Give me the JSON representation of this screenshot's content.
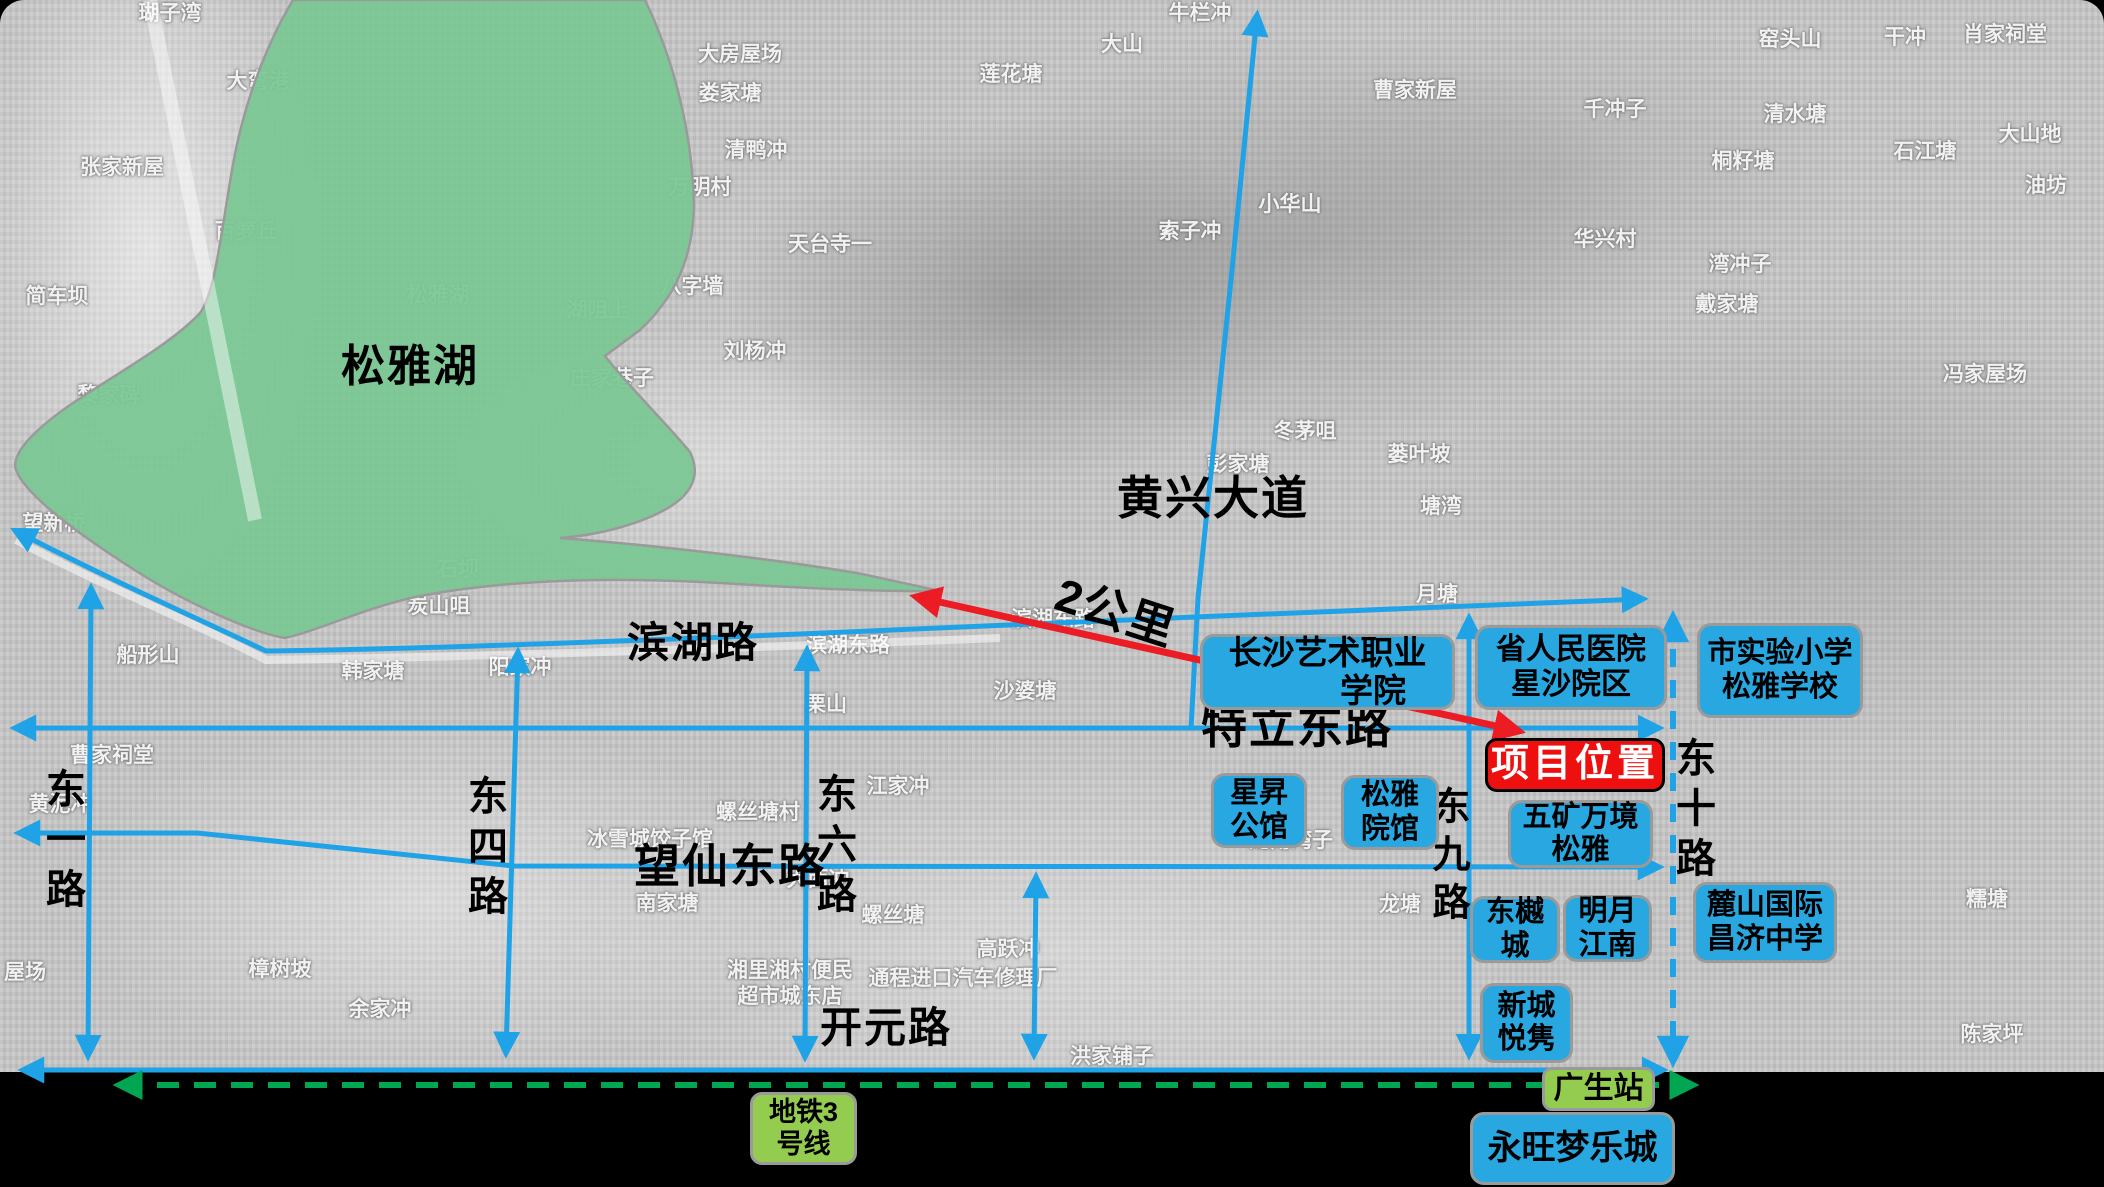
{
  "lake": {
    "name": "松雅湖",
    "fill_color": "#7bc795"
  },
  "scale_arrow": {
    "label": "2公里",
    "color": "#ec1c24"
  },
  "colors": {
    "road_blue": "#1fa3e6",
    "poi_blue": "#29a7e0",
    "metro_green": "#00a651",
    "station_green": "#94cc50",
    "project_red": "#ee0f0f"
  },
  "road_labels": [
    {
      "t": "松雅湖",
      "x": 410,
      "y": 367,
      "fs": 44,
      "vert": 0,
      "rot": 0
    },
    {
      "t": "滨湖路",
      "x": 693,
      "y": 643,
      "fs": 42,
      "vert": 0,
      "rot": 0
    },
    {
      "t": "特立东路",
      "x": 1297,
      "y": 727,
      "fs": 46,
      "vert": 0,
      "rot": 0
    },
    {
      "t": "望仙东路",
      "x": 730,
      "y": 866,
      "fs": 46,
      "vert": 0,
      "rot": 0
    },
    {
      "t": "开元路",
      "x": 886,
      "y": 1028,
      "fs": 42,
      "vert": 0,
      "rot": 0
    },
    {
      "t": "黄兴大道",
      "x": 1213,
      "y": 498,
      "fs": 46,
      "vert": 0,
      "rot": 0
    },
    {
      "t": "2公里",
      "x": 1116,
      "y": 612,
      "fs": 46,
      "vert": 0,
      "rot": 18
    },
    {
      "t": "东一路",
      "x": 62,
      "y": 843,
      "fs": 40,
      "vert": 1,
      "rot": 0
    },
    {
      "t": "东四路",
      "x": 484,
      "y": 850,
      "fs": 40,
      "vert": 1,
      "rot": 0
    },
    {
      "t": "东六路",
      "x": 833,
      "y": 848,
      "fs": 40,
      "vert": 1,
      "rot": 0
    },
    {
      "t": "东九路",
      "x": 1447,
      "y": 858,
      "fs": 38,
      "vert": 1,
      "rot": 0
    },
    {
      "t": "东十路",
      "x": 1692,
      "y": 812,
      "fs": 40,
      "vert": 1,
      "rot": 0
    }
  ],
  "boxes": [
    {
      "kind": "project",
      "name": "project-location",
      "x": 1485,
      "y": 738,
      "w": 180,
      "h": 54,
      "fs": 38,
      "lines": [
        "项目位置"
      ]
    },
    {
      "kind": "poi",
      "name": "changsha-art-college",
      "x": 1200,
      "y": 634,
      "w": 255,
      "h": 76,
      "fs": 33,
      "lines": [
        "长沙艺术职业",
        "学院"
      ],
      "align2": "right"
    },
    {
      "kind": "poi",
      "name": "provincial-peoples-hospital",
      "x": 1475,
      "y": 625,
      "w": 192,
      "h": 85,
      "fs": 30,
      "lines": [
        "省人民医院",
        "星沙院区"
      ]
    },
    {
      "kind": "poi",
      "name": "city-experimental-primary-school",
      "x": 1697,
      "y": 623,
      "w": 166,
      "h": 95,
      "fs": 29,
      "lines": [
        "市实验小学",
        "松雅学校"
      ]
    },
    {
      "kind": "poi",
      "name": "xingsheng-mansion",
      "x": 1211,
      "y": 773,
      "w": 96,
      "h": 75,
      "fs": 29,
      "lines": [
        "星昇",
        "公馆"
      ]
    },
    {
      "kind": "poi",
      "name": "songya-yuanguan",
      "x": 1341,
      "y": 775,
      "w": 98,
      "h": 75,
      "fs": 29,
      "lines": [
        "松雅",
        "院馆"
      ]
    },
    {
      "kind": "poi",
      "name": "wukuang-wanjing-songya",
      "x": 1508,
      "y": 800,
      "w": 145,
      "h": 68,
      "fs": 29,
      "lines": [
        "五矿万境",
        "松雅"
      ]
    },
    {
      "kind": "poi",
      "name": "dongyue-city",
      "x": 1470,
      "y": 896,
      "w": 90,
      "h": 67,
      "fs": 29,
      "lines": [
        "东樾",
        "城"
      ]
    },
    {
      "kind": "poi",
      "name": "mingyue-jiangnan",
      "x": 1563,
      "y": 895,
      "w": 89,
      "h": 67,
      "fs": 29,
      "lines": [
        "明月",
        "江南"
      ]
    },
    {
      "kind": "poi",
      "name": "lushan-international-school",
      "x": 1693,
      "y": 882,
      "w": 144,
      "h": 81,
      "fs": 29,
      "lines": [
        "麓山国际",
        "昌济中学"
      ]
    },
    {
      "kind": "poi",
      "name": "xincheng-yuejun",
      "x": 1480,
      "y": 983,
      "w": 93,
      "h": 80,
      "fs": 29,
      "lines": [
        "新城",
        "悦隽"
      ]
    },
    {
      "kind": "poi",
      "name": "aeon-mall",
      "x": 1470,
      "y": 1112,
      "w": 205,
      "h": 73,
      "fs": 34,
      "lines": [
        "永旺梦乐城"
      ]
    },
    {
      "kind": "station",
      "name": "guangsheng-station",
      "x": 1542,
      "y": 1067,
      "w": 113,
      "h": 44,
      "fs": 30,
      "lines": [
        "广生站"
      ]
    },
    {
      "kind": "metro",
      "name": "metro-line-3",
      "x": 750,
      "y": 1092,
      "w": 107,
      "h": 73,
      "fs": 27,
      "lines": [
        "地铁3",
        "号线"
      ]
    }
  ],
  "bg_labels": [
    {
      "t": "瑚子湾",
      "x": 170,
      "y": 14
    },
    {
      "t": "大弯港",
      "x": 258,
      "y": 82
    },
    {
      "t": "张家新屋",
      "x": 122,
      "y": 168
    },
    {
      "t": "百箩丘",
      "x": 246,
      "y": 232
    },
    {
      "t": "简车坝",
      "x": 57,
      "y": 297
    },
    {
      "t": "黎家碑",
      "x": 109,
      "y": 396
    },
    {
      "t": "望新桥",
      "x": 54,
      "y": 524
    },
    {
      "t": "船形山",
      "x": 148,
      "y": 656
    },
    {
      "t": "曹家祠堂",
      "x": 112,
      "y": 756
    },
    {
      "t": "黄泥冲",
      "x": 60,
      "y": 805
    },
    {
      "t": "屋场",
      "x": 25,
      "y": 973
    },
    {
      "t": "樟树坡",
      "x": 280,
      "y": 970
    },
    {
      "t": "余家冲",
      "x": 380,
      "y": 1010
    },
    {
      "t": "松雅湖",
      "x": 438,
      "y": 296
    },
    {
      "t": "湖咀上",
      "x": 598,
      "y": 311
    },
    {
      "t": "庄家巷子",
      "x": 612,
      "y": 379
    },
    {
      "t": "八字墙",
      "x": 692,
      "y": 287
    },
    {
      "t": "大房屋场",
      "x": 740,
      "y": 55
    },
    {
      "t": "娄家塘",
      "x": 730,
      "y": 94
    },
    {
      "t": "清鸭冲",
      "x": 756,
      "y": 151
    },
    {
      "t": "万明村",
      "x": 700,
      "y": 188
    },
    {
      "t": "天台寺一",
      "x": 830,
      "y": 245
    },
    {
      "t": "刘杨冲",
      "x": 755,
      "y": 352
    },
    {
      "t": "石坝",
      "x": 458,
      "y": 570
    },
    {
      "t": "炭山咀",
      "x": 439,
      "y": 607
    },
    {
      "t": "韩家塘",
      "x": 373,
      "y": 672
    },
    {
      "t": "阳家冲",
      "x": 520,
      "y": 668
    },
    {
      "t": "滨湖东路",
      "x": 848,
      "y": 646
    },
    {
      "t": "滨湖东路",
      "x": 1053,
      "y": 620
    },
    {
      "t": "沙婆塘",
      "x": 1025,
      "y": 692
    },
    {
      "t": "栗山",
      "x": 826,
      "y": 705
    },
    {
      "t": "江家冲",
      "x": 898,
      "y": 787
    },
    {
      "t": "螺丝塘村",
      "x": 758,
      "y": 813
    },
    {
      "t": "冰雪城饺子馆",
      "x": 650,
      "y": 840
    },
    {
      "t": "大西冲",
      "x": 818,
      "y": 880
    },
    {
      "t": "南家塘",
      "x": 667,
      "y": 904
    },
    {
      "t": "螺丝塘",
      "x": 893,
      "y": 916
    },
    {
      "t": "高跃冲",
      "x": 1008,
      "y": 950
    },
    {
      "t": "湘里湘村便民\n超市城东店",
      "x": 790,
      "y": 984
    },
    {
      "t": "通程进口汽车修理厂",
      "x": 963,
      "y": 979
    },
    {
      "t": "洪家铺子",
      "x": 1112,
      "y": 1057
    },
    {
      "t": "龙角湾子",
      "x": 1291,
      "y": 841
    },
    {
      "t": "龙塘",
      "x": 1400,
      "y": 905
    },
    {
      "t": "牛栏冲",
      "x": 1200,
      "y": 14
    },
    {
      "t": "大山",
      "x": 1122,
      "y": 45
    },
    {
      "t": "莲花塘",
      "x": 1011,
      "y": 75
    },
    {
      "t": "曹家新屋",
      "x": 1415,
      "y": 91
    },
    {
      "t": "千冲子",
      "x": 1615,
      "y": 110
    },
    {
      "t": "桐籽塘",
      "x": 1743,
      "y": 162
    },
    {
      "t": "清水塘",
      "x": 1795,
      "y": 115
    },
    {
      "t": "石江塘",
      "x": 1925,
      "y": 152
    },
    {
      "t": "大山地",
      "x": 2030,
      "y": 135
    },
    {
      "t": "油坊",
      "x": 2046,
      "y": 186
    },
    {
      "t": "窑头山",
      "x": 1790,
      "y": 40
    },
    {
      "t": "干冲",
      "x": 1905,
      "y": 38
    },
    {
      "t": "肖家祠堂",
      "x": 2005,
      "y": 35
    },
    {
      "t": "小华山",
      "x": 1290,
      "y": 205
    },
    {
      "t": "索子冲",
      "x": 1190,
      "y": 232
    },
    {
      "t": "华兴村",
      "x": 1605,
      "y": 240
    },
    {
      "t": "湾冲子",
      "x": 1740,
      "y": 265
    },
    {
      "t": "戴家塘",
      "x": 1727,
      "y": 305
    },
    {
      "t": "冯家屋场",
      "x": 1985,
      "y": 375
    },
    {
      "t": "冬茅咀",
      "x": 1305,
      "y": 432
    },
    {
      "t": "彭家塘",
      "x": 1238,
      "y": 465
    },
    {
      "t": "蒌叶坡",
      "x": 1419,
      "y": 455
    },
    {
      "t": "塘湾",
      "x": 1441,
      "y": 507
    },
    {
      "t": "月塘",
      "x": 1437,
      "y": 595
    },
    {
      "t": "糯塘",
      "x": 1987,
      "y": 900
    },
    {
      "t": "陈家坪",
      "x": 1992,
      "y": 1035
    }
  ]
}
